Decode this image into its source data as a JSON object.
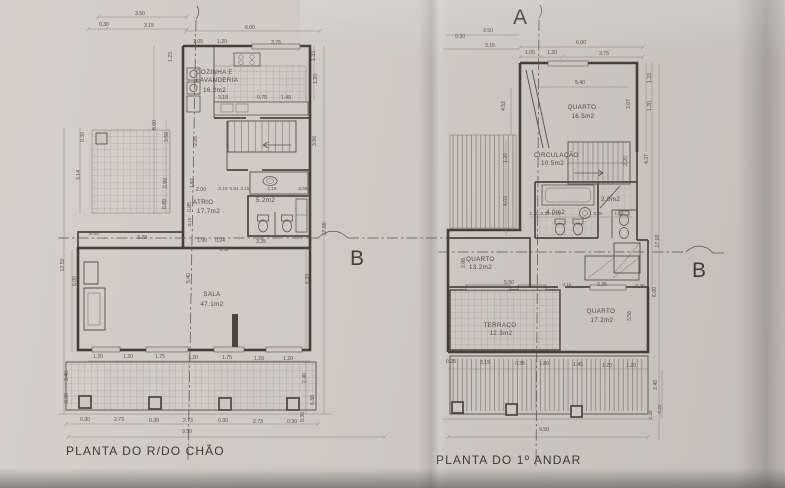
{
  "ground": {
    "title": "PLANTA DO R/DO CHÃO",
    "section_b": "B",
    "rooms": {
      "kitchen": {
        "line1": "COZINHA E",
        "line2": "LAVANDERIA",
        "area": "16.2m2"
      },
      "atrio": {
        "name": "ATRIO",
        "area": "17.7m2"
      },
      "bath": {
        "area": "5.2m2"
      },
      "sala": {
        "name": "SALA",
        "area": "47.1m2"
      }
    },
    "dims": {
      "top": [
        "3.50",
        "0.30",
        "3.15",
        "6.00",
        "1.05",
        "1.20",
        "3.75"
      ],
      "kitchen": [
        "3.18",
        "0.75",
        "1.48"
      ],
      "atrio": [
        "2.00",
        "0.15",
        "0.84",
        "0.15",
        "2.16",
        "0.55"
      ],
      "mid": [
        "0.30",
        "3.78",
        "1.90",
        "0.24",
        "3.25",
        "0.55"
      ],
      "left": [
        "0.30",
        "3.14",
        "8.00",
        "3.58",
        "0.99",
        "0.89",
        "12.50",
        "6.00",
        "2.40",
        "0.30",
        "1.23"
      ],
      "right": [
        "1.33",
        "1.20",
        "2.20",
        "1.57",
        "0.85",
        "0.15",
        "3.96",
        "17.00",
        "6.39",
        "2.40",
        "6.38",
        "0.30"
      ],
      "sala": [
        "5.40"
      ],
      "windows": [
        "1.20",
        "1.20",
        "1.75",
        "1.20",
        "1.75",
        "1.20",
        "1.20"
      ],
      "terrace": [
        "0.30",
        "2.73",
        "0.30",
        "2.73",
        "0.30",
        "2.73",
        "0.30"
      ],
      "overall": "9.50"
    }
  },
  "first": {
    "title": "PLANTA DO 1º ANDAR",
    "section_a": "A",
    "section_b": "B",
    "rooms": {
      "quarto1": {
        "name": "QUARTO",
        "area": "16.5m2"
      },
      "circulacao": {
        "name": "CIRCULAÇÃO",
        "area": "10.5m2"
      },
      "quarto2": {
        "name": "QUARTO",
        "area": "13.2m2"
      },
      "terraco": {
        "name": "TERRAÇO",
        "area": "12.3m2"
      },
      "quarto3": {
        "name": "QUARTO",
        "area": "17.2m2"
      },
      "bath": {
        "area": "4.0m2"
      },
      "shower": {
        "area": "2.0m2"
      }
    },
    "dims": {
      "top": [
        "3.50",
        "0.30",
        "3.15",
        "6.00",
        "1.05",
        "1.20",
        "3.75"
      ],
      "quarto1": [
        "5.40"
      ],
      "left": [
        "4.52",
        "1.20",
        "4.03",
        "2.88"
      ],
      "right": [
        "1.33",
        "1.20",
        "3.07",
        "4.37",
        "2.20",
        "17.00",
        "6.00",
        "3.56"
      ],
      "bath": [
        "1.20",
        "0.15",
        "1.25",
        "0.30",
        "1.50"
      ],
      "band": [
        "5.50",
        "0.15",
        "3.25",
        "0.30"
      ],
      "bottom": [
        "0.25",
        "3.15",
        "0.35",
        "1.80",
        "1.45",
        "1.20",
        "1.20"
      ],
      "corner": [
        "2.40",
        "0.30",
        "0.20"
      ],
      "overall": "9.50"
    }
  }
}
